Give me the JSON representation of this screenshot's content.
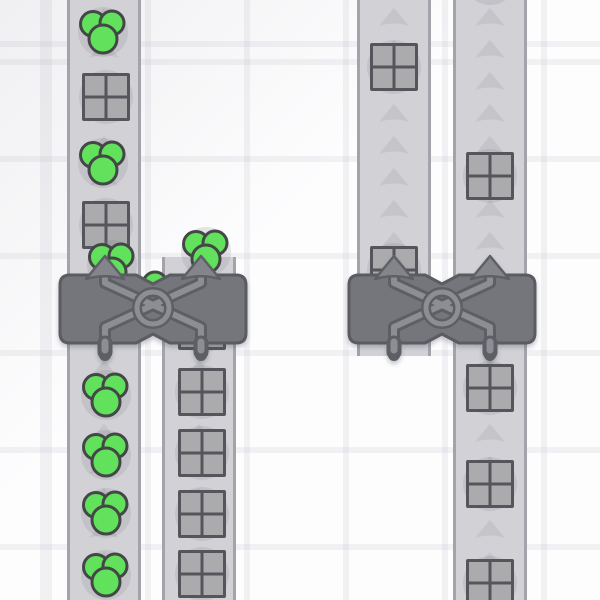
{
  "scene": {
    "name": "factory-belt-scene",
    "canvas": {
      "width": 600,
      "height": 600
    }
  },
  "palette": {
    "background": "#fdfdfe",
    "grid_line": "#ededf1",
    "belt_fill": "#d2d2d6",
    "belt_edge": "#a2a3ab",
    "belt_arrow": "#c4c4c9",
    "item_shadow": "rgba(120,120,140,0.18)",
    "square_fill": "#ababad",
    "square_border": "#54565b",
    "green_fill": "#62e25c",
    "green_border": "#434847",
    "machine_body": "#74767c",
    "machine_outline": "#5a5c62",
    "machine_detail_dark": "#5d5f65",
    "machine_detail_light": "#8c8e94",
    "machine_arrow_fill": "#83858b",
    "machine_arrow_border": "#5e6066"
  },
  "grid": {
    "spacing_x": 99,
    "spacing_y": 97,
    "offset_x": 46,
    "offset_y": 59,
    "line_width": 6
  },
  "belts": [
    {
      "id": "belt-left-outer",
      "x": 67,
      "y0": 0,
      "y1": 600,
      "w": 74
    },
    {
      "id": "belt-left-inner",
      "x": 162,
      "y0": 257,
      "y1": 600,
      "w": 74
    },
    {
      "id": "belt-right-inner",
      "x": 357,
      "y0": 0,
      "y1": 356,
      "w": 74
    },
    {
      "id": "belt-right-outer",
      "x": 453,
      "y0": 0,
      "y1": 600,
      "w": 74
    }
  ],
  "belt_arrow_geom": {
    "width": 30,
    "height": 18,
    "spacing": 32,
    "phase": 8
  },
  "item_geom": {
    "square_size": 48,
    "square_shadow_r": 27,
    "circle_shadow_r": 25,
    "cluster": [
      {
        "dx": -10,
        "dy": -8,
        "r": 12.5
      },
      {
        "dx": 9,
        "dy": -9,
        "r": 12
      },
      {
        "dx": 0,
        "dy": 7,
        "r": 14
      }
    ],
    "single_r": 12
  },
  "items": [
    {
      "type": "circles",
      "x": 103,
      "y": 32
    },
    {
      "type": "square",
      "x": 106,
      "y": 97
    },
    {
      "type": "circles",
      "x": 103,
      "y": 163
    },
    {
      "type": "square",
      "x": 106,
      "y": 225
    },
    {
      "type": "circles",
      "x": 112,
      "y": 265
    },
    {
      "type": "circles",
      "x": 206,
      "y": 252
    },
    {
      "type": "circle1",
      "x": 155,
      "y": 284
    },
    {
      "type": "square",
      "x": 202,
      "y": 326
    },
    {
      "type": "square",
      "x": 202,
      "y": 392
    },
    {
      "type": "square",
      "x": 202,
      "y": 453
    },
    {
      "type": "square",
      "x": 202,
      "y": 514
    },
    {
      "type": "square",
      "x": 202,
      "y": 574
    },
    {
      "type": "circles",
      "x": 106,
      "y": 395
    },
    {
      "type": "circles",
      "x": 106,
      "y": 455
    },
    {
      "type": "circles",
      "x": 106,
      "y": 513
    },
    {
      "type": "circles",
      "x": 106,
      "y": 575
    },
    {
      "type": "square",
      "x": 394,
      "y": 67
    },
    {
      "type": "square",
      "x": 394,
      "y": 270
    },
    {
      "type": "shadow",
      "x": 490,
      "y": -22
    },
    {
      "type": "square",
      "x": 490,
      "y": 176
    },
    {
      "type": "square",
      "x": 490,
      "y": 388
    },
    {
      "type": "square",
      "x": 490,
      "y": 484
    },
    {
      "type": "square",
      "x": 490,
      "y": 583
    }
  ],
  "machines": [
    {
      "id": "balancer-left",
      "cx": 153,
      "top": 255
    },
    {
      "id": "balancer-right",
      "cx": 442,
      "top": 255
    }
  ],
  "machine_geom": {
    "half_width": 93,
    "body_top": 20,
    "body_bottom": 88,
    "tile_dx": 48,
    "ring_cx": 95,
    "ring_cy": 53,
    "ring_r": 16,
    "arrow": {
      "tip_y": 1,
      "base_y": 24,
      "half_w": 19
    },
    "leg": {
      "y0": 88,
      "y1": 97
    }
  }
}
